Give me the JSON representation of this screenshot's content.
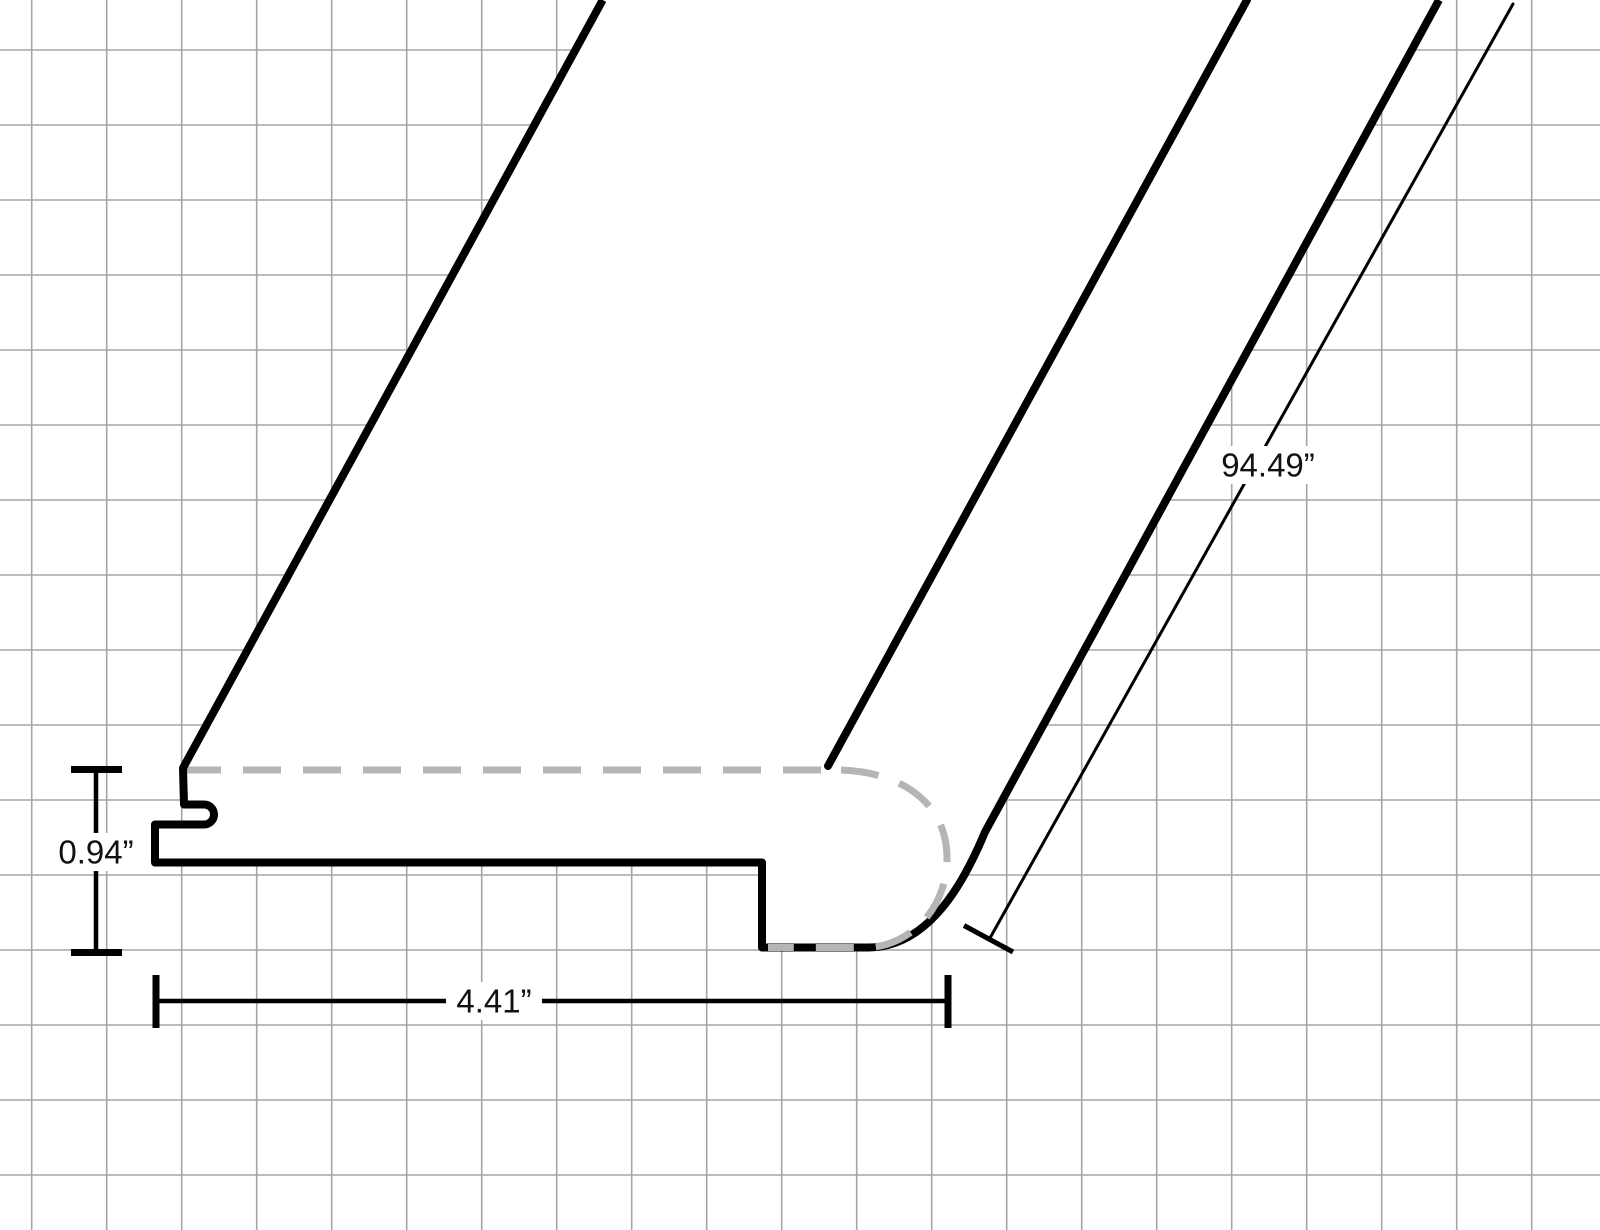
{
  "drawing": {
    "kind": "flooring-stair-nose-profile-diagram",
    "dimensions": {
      "thickness_label": "0.94”",
      "width_label": "4.41”",
      "length_label": "94.49”"
    },
    "colors": {
      "outline": "#000000",
      "hidden_edge_dash": "#b5b5b5",
      "grid_line": "#a5a5a5",
      "background": "#ffffff",
      "label_text": "#111111"
    }
  }
}
